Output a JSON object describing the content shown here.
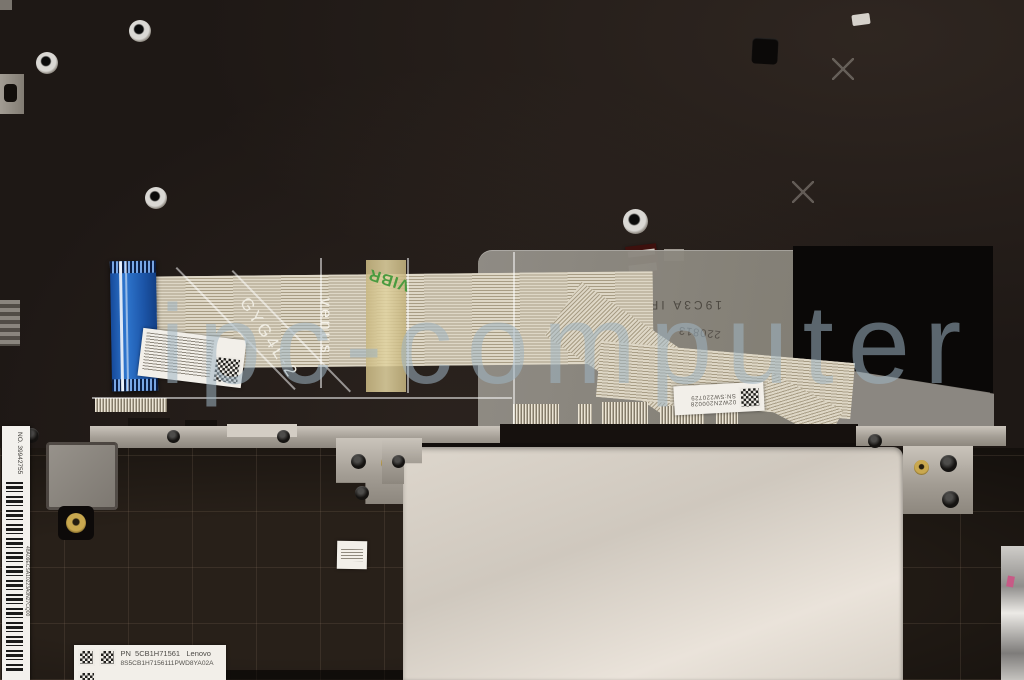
{
  "watermark": {
    "text": "ipc-computer",
    "color": "#9fb4c2"
  },
  "markings": {
    "cable_model": "GYG4L-2",
    "cable_brand": "venus",
    "cable_tape": "VIBR",
    "sheet_line1": "19C3A IR",
    "sheet_line2": "220813",
    "sheet_line3": "SU",
    "sheet_line4": "IC"
  },
  "labels": {
    "connector": {
      "line1": "02WZN200028",
      "line2": "SN:SW220729"
    },
    "part": {
      "prefix": "PN",
      "part_number": "5CB1H71561",
      "brand": "Lenovo",
      "code": "8S5CB1H7156111PWD8YA02A"
    },
    "side": {
      "number": "NO. 39942755",
      "code": "48A09ECSA10223A0N27CQ00"
    }
  }
}
